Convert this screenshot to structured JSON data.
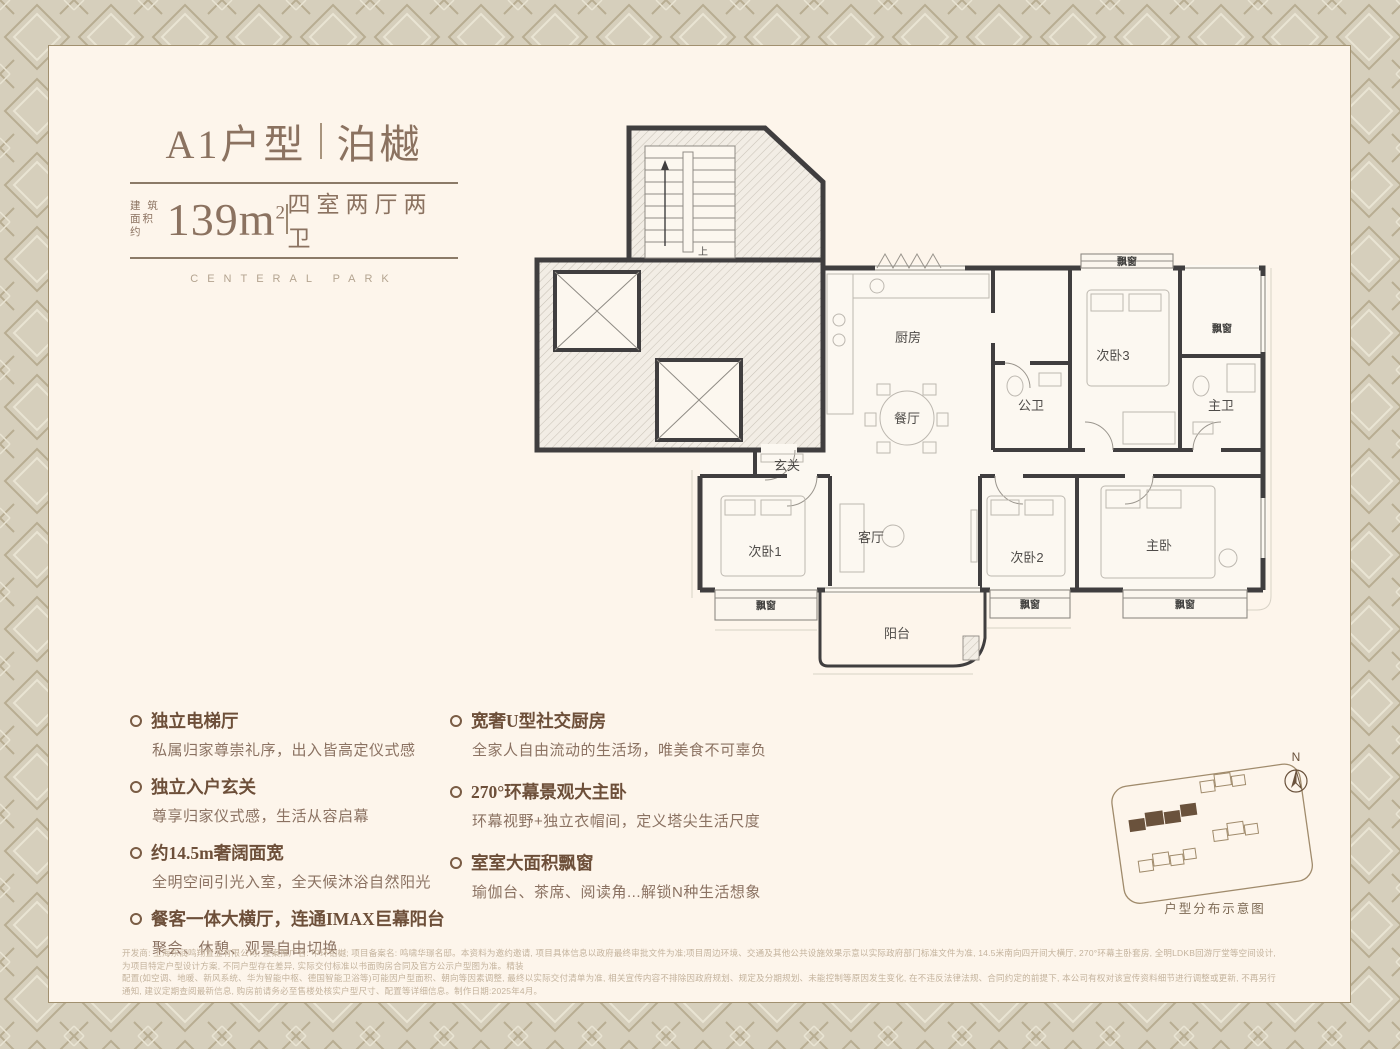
{
  "header": {
    "model": "A1户型",
    "name": "泊樾",
    "area_label_top": "建 筑",
    "area_label_bottom": "面积约",
    "area_value": "139m",
    "area_exp": "2",
    "rooms_desc": "四室两厅两卫",
    "subtitle": "CENTERAL PARK"
  },
  "floorplan": {
    "labels": {
      "kitchen": "厨房",
      "dining": "餐厅",
      "public_bath": "公卫",
      "bedroom3": "次卧3",
      "master_bath": "主卫",
      "foyer": "玄关",
      "living": "客厅",
      "bedroom1": "次卧1",
      "bedroom2": "次卧2",
      "master_bedroom": "主卧",
      "balcony": "阳台",
      "bay_window": "飘窗",
      "stairs_up": "上"
    }
  },
  "features": {
    "left": [
      {
        "title": "独立电梯厅",
        "desc": "私属归家尊崇礼序，出入皆高定仪式感"
      },
      {
        "title": "独立入户玄关",
        "desc": "尊享归家仪式感，生活从容启幕"
      },
      {
        "title": "约14.5m奢阔面宽",
        "desc": "全明空间引光入室，全天候沐浴自然阳光"
      },
      {
        "title": "餐客一体大横厅，连通IMAX巨幕阳台",
        "desc": "聚会、休憩、观景自由切换"
      }
    ],
    "right": [
      {
        "title": "宽奢U型社交厨房",
        "desc": "全家人自由流动的生活场，唯美食不可辜负"
      },
      {
        "title": "270°环幕景观大主卧",
        "desc": "环幕视野+独立衣帽间，定义塔尖生活尺度"
      },
      {
        "title": "室室大面积飘窗",
        "desc": "瑜伽台、茶席、阅读角...解锁N种生活想象"
      }
    ]
  },
  "siteplan": {
    "caption": "户型分布示意图",
    "north_label": "N"
  },
  "disclaimer": {
    "line1": "开发商: 上海东润鸣翔置业有限公司; 整案推广名: 中环铂樾; 项目备案名: 鸣啸华璟名邸。本资料为邀约邀请, 项目具体信息以政府最终审批文件为准;项目周边环境、交通及其他公共设施效果示意以实际政府部门标准文件为准, 14.5米南向四开间大横厅, 270°环幕主卧套房, 全明LDKB回游厅堂等空间设计, 为项目特定户型设计方案, 不同户型存在差异, 实际交付标准以书面购房合同及官方公示户型图为准。精装",
    "line2": "配置(如空调、地暖、新风系统、华为智能中枢、德国智能卫浴等)可能因户型面积、朝向等因素调整, 最终以实际交付清单为准, 相关宣传内容不排除因政府规划、规定及分期规划、未能控制等原因发生变化, 在不违反法律法规、合同约定的前提下, 本公司有权对该宣传资料细节进行调整或更新, 不再另行通知, 建议定期查阅最新信息, 购房前请务必至售楼处核实户型尺寸、配置等详细信息。制作日期:2025年4月。"
  },
  "colors": {
    "border_bg": "#d6cfbc",
    "pattern_dark": "#b8ad92",
    "pattern_light": "#e9e4d3",
    "panel_bg": "#fdf5eb",
    "accent_brown": "#8b7260",
    "feature_title": "#6d4f39",
    "wall": "#403e3f",
    "site_highlight": "#6a523c",
    "disclaimer_text": "#c4b39d"
  }
}
